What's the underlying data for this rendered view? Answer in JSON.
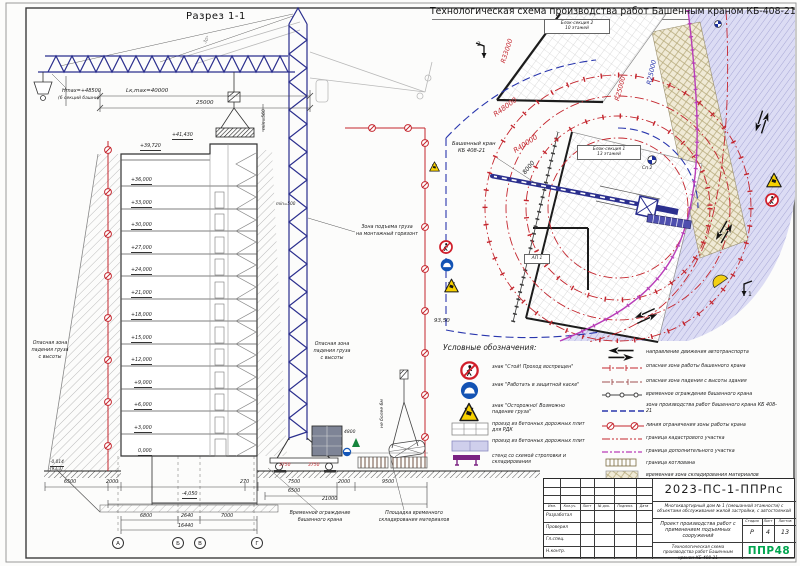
{
  "colors": {
    "accent_red": "#c4262e",
    "crane_blue": "#2b2f8e",
    "magenta": "#b83db8",
    "road_fill": "#dcdcf4",
    "storage_fill": "#f0ead6",
    "logo_green": "#00a54f"
  },
  "titles": {
    "section": "Разрез 1-1",
    "plan": "Технологическая схема производства работ Башенным краном КБ-408-21"
  },
  "crane_dims": {
    "hmax": "Hmax=+48500",
    "hmax_note": "(6 секций башни)",
    "lk": "Lк,max=40000",
    "span": "25000",
    "min560": "min=560",
    "min500": "min=500",
    "deg": "30°",
    "counter": "4800",
    "rail_l": "3750",
    "rail_r": "3750"
  },
  "levels": [
    "+41,430",
    "+39,720",
    "+36,000",
    "+33,000",
    "+30,000",
    "+27,000",
    "+24,000",
    "+21,000",
    "+18,000",
    "+15,000",
    "+12,000",
    "+9,000",
    "+6,000",
    "+3,000",
    "0,000",
    "-4,050"
  ],
  "marks": {
    "ground": "-0,014",
    "ground2": "(93,3)",
    "plan_level": "93,50"
  },
  "zone_labels": {
    "lift1": "Зона подъема груза",
    "lift2": "на монтажный горизонт",
    "danger1": "Опасная зона",
    "danger2": "падения груза",
    "danger3": "с высоты",
    "load_limit": "не более 6м"
  },
  "bottom_labels": {
    "fence1": "Временное ограждение",
    "fence2": "башенного крана",
    "stock1": "Площадка временного",
    "stock2": "складирования материалов"
  },
  "dims": {
    "d6500l": "6500",
    "d2000l": "2000",
    "d270": "270",
    "d7500": "7500",
    "d2000r": "2000",
    "d9500": "9500",
    "d6500m": "6500",
    "d21000": "21000",
    "d6800": "6800",
    "d2640": "2640",
    "d7000": "7000",
    "d16440": "16440"
  },
  "axes": [
    "А",
    "Б",
    "В",
    "Г"
  ],
  "plan": {
    "crane1": "Башенный кран",
    "crane2": "КБ 408-21",
    "block1a": "Блок-секция 1",
    "block1b": "13 этажей",
    "block2a": "Блок-секция 2",
    "block2b": "10 этажей",
    "r33": "R33000",
    "r48": "R48000",
    "r40": "R40000",
    "r25r": "R25000",
    "r25b": "R25000",
    "d8000": "8000",
    "ap1": "АП 1",
    "sp2": "Сп 2",
    "m1": "1",
    "m2": "2"
  },
  "legend": {
    "heading": "Условные обозначения:",
    "left": [
      "знак \"Стой! Проход воспрещен\"",
      "знак \"Работать в защитной каске\"",
      "знак \"Осторожно! Возможно падение груза\"",
      "проезд из бетонных дорожных плит для РДК",
      "проезд из бетонных дорожных плит",
      "стенд со схемой строповки и складирования"
    ],
    "right": [
      "направление движения автотранспорта",
      "опасная зона работы башенного крана",
      "опасная зона падения с высоты здания",
      "временное ограждение башенного крана",
      "зона производства работ башенного крана КБ 408-21",
      "линия ограничения зоны работы крана",
      "граница кадастрового участка",
      "граница дополнительного участка",
      "граница котлована",
      "временная зона складирования материалов"
    ]
  },
  "stamp": {
    "doc": "2023-ПС-1-ППРпс",
    "project": "Многоквартирный дом № 1 (смешанной этажности) с объектами обслуживания жилой застройки, с автостоянкой",
    "cols": [
      "Изм.",
      "Кол.уч.",
      "Лист",
      "№ док.",
      "Подпись",
      "Дата"
    ],
    "roles": [
      "Разработал",
      "Проверил",
      "Гл.спец.",
      "Н.контр."
    ],
    "work": "Проект производства работ с применением подъемных сооружений",
    "stage_h": [
      "Стадия",
      "Лист",
      "Листов"
    ],
    "stage": "Р",
    "sheet_no": "4",
    "sheets": "13",
    "sheet_title": "Технологическая схема производства работ Башенным краном КБ-408-21",
    "logo": "ППР48"
  }
}
